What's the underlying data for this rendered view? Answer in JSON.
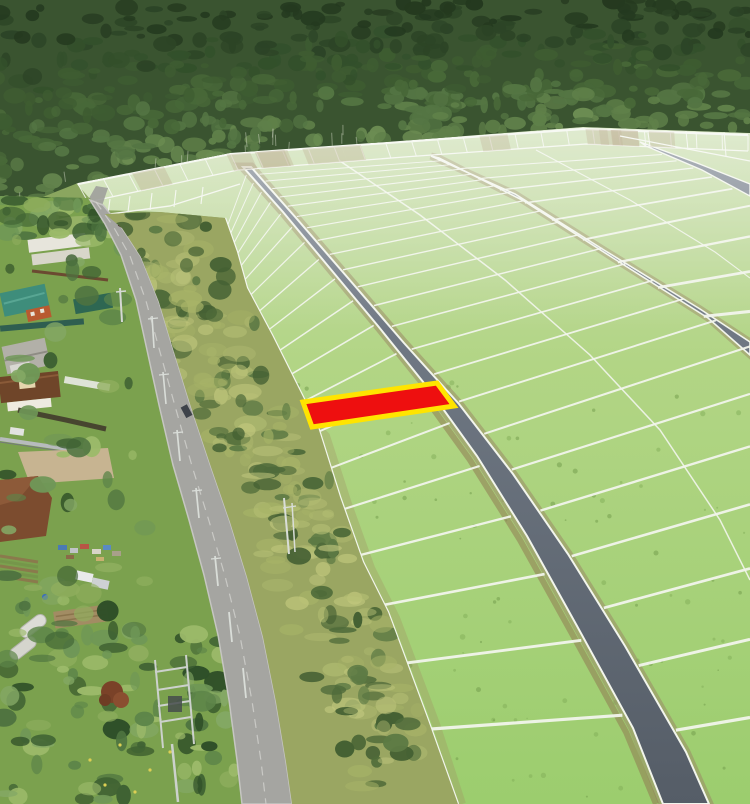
{
  "meta": {
    "title": "aerial-land-plots-photo",
    "width": 750,
    "height": 804,
    "description": "Drone aerial photo: subdivided land plots on a green field beside a forest and a village road; one plot is highlighted red with a yellow outline"
  },
  "palette": {
    "plot_fill": "#ee0f0f",
    "plot_stroke": "#ffe400",
    "field_top": "#c9dcae",
    "field_mid": "#b2d585",
    "field_bottom": "#9ccd6e",
    "grid_line": "#f2f5ec",
    "road_gray_top": "#7b8490",
    "road_gray_bottom": "#555d67",
    "shoulder": "#9b8a66",
    "asphalt": "#a5a5a1",
    "asphalt_edge": "#c6c6c2",
    "forest_base": "#3a5430",
    "forest_palette": [
      "#24391f",
      "#2c4426",
      "#33502b",
      "#3e5c31",
      "#486838",
      "#547543",
      "#5f8049",
      "#6b8c52"
    ],
    "scrub_base": "#9aa662",
    "scrub_bush": [
      "#4f6b3a",
      "#5d7a44",
      "#446033"
    ],
    "scrub_grass": [
      "#b5bf74",
      "#c2c87e",
      "#a8b468"
    ],
    "village_grass": "#7ba14e",
    "village_tree_palette": [
      "#3f6233",
      "#4e7340",
      "#5d8549",
      "#6f9757",
      "#84a865",
      "#2f4f28"
    ]
  },
  "overlay": {
    "highlighted_plot": {
      "points": "303,402 437,383 454,406 312,427"
    }
  },
  "scene": {
    "grid": {
      "blocks": [
        {
          "rows": 20,
          "gamma": 1.13,
          "left": [
            [
              225,
              218
            ],
            [
              237,
              252
            ],
            [
              247,
              288
            ],
            [
              272,
              335
            ],
            [
              297,
              385
            ],
            [
              318,
              427
            ],
            [
              340,
              497
            ],
            [
              363,
              562
            ],
            [
              388,
              612
            ],
            [
              428,
              720
            ],
            [
              458,
              804
            ]
          ],
          "right": [
            [
              240,
              168
            ],
            [
              280,
              213
            ],
            [
              325,
              267
            ],
            [
              375,
              327
            ],
            [
              425,
              389
            ],
            [
              474,
              457
            ],
            [
              524,
              537
            ],
            [
              574,
              627
            ],
            [
              630,
              729
            ],
            [
              660,
              804
            ]
          ]
        },
        {
          "rows": 24,
          "gamma": 1.105,
          "left": [
            [
              254,
              168
            ],
            [
              300,
              220
            ],
            [
              351,
              279
            ],
            [
              407,
              344
            ],
            [
              462,
              405
            ],
            [
              516,
              475
            ],
            [
              571,
              555
            ],
            [
              628,
              647
            ],
            [
              689,
              753
            ],
            [
              712,
              804
            ]
          ],
          "right": [
            [
              434,
              157
            ],
            [
              520,
              197
            ],
            [
              610,
              253
            ],
            [
              705,
              312
            ],
            [
              750,
              346
            ],
            [
              750,
              560
            ],
            [
              750,
              804
            ]
          ]
        },
        {
          "rows": 10,
          "gamma": 1.14,
          "left": [
            [
              442,
              160
            ],
            [
              527,
              204
            ],
            [
              616,
              261
            ],
            [
              711,
              321
            ],
            [
              750,
              357
            ]
          ],
          "right": [
            [
              649,
              149
            ],
            [
              705,
              173
            ],
            [
              750,
              199
            ],
            [
              750,
              357
            ]
          ]
        }
      ],
      "topstrip": {
        "a": [
          [
            78,
            184
          ],
          [
            230,
            154
          ],
          [
            400,
            142
          ],
          [
            583,
            129
          ],
          [
            748,
            135
          ]
        ],
        "b": [
          [
            88,
            202
          ],
          [
            238,
            170
          ],
          [
            404,
            157
          ],
          [
            586,
            144
          ],
          [
            748,
            151
          ]
        ],
        "ticks": 26
      },
      "spines": [
        [
          [
            340,
            161
          ],
          [
            420,
            215
          ],
          [
            505,
            280
          ],
          [
            590,
            355
          ],
          [
            660,
            430
          ],
          [
            720,
            520
          ],
          [
            750,
            580
          ]
        ],
        [
          [
            536,
            150
          ],
          [
            630,
            200
          ],
          [
            715,
            252
          ],
          [
            750,
            278
          ]
        ]
      ]
    },
    "textures": {
      "forest": {
        "count": 560,
        "seed": 7
      },
      "scrub": {
        "count": 250,
        "seed": 11
      },
      "village": {
        "seed": 23,
        "zones": [
          {
            "x": [
              0,
              115
            ],
            "y": [
              190,
              244
            ],
            "n": 42
          },
          {
            "x": [
              0,
              155
            ],
            "y": [
              244,
              635
            ],
            "n": 52
          },
          {
            "x": [
              0,
              238
            ],
            "y": [
              626,
              804
            ],
            "n": 100
          }
        ]
      },
      "field_speckles": {
        "count": 120,
        "seed": 31
      },
      "topstrip_patches": {
        "count": 12,
        "seed": 41
      }
    }
  }
}
